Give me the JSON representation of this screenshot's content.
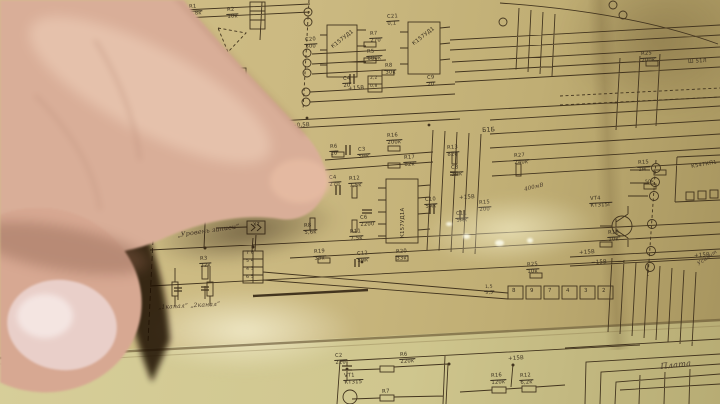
{
  "scene": {
    "palette": {
      "paper": "#cbb981",
      "paper_light": "#d8cf9b",
      "ink": "#3a3020",
      "skin": "#d9ae98",
      "skin_shadow": "#c79b85",
      "nail": "#e9cfc9",
      "deep_shadow": "#1a0d05",
      "tape_shine": "#fff9d7"
    }
  },
  "schematic": {
    "labels": [
      {
        "t": "R1|6,8к",
        "x": 188,
        "y": 5
      },
      {
        "t": "R2|10к",
        "x": 226,
        "y": 8
      },
      {
        "t": "Гром.",
        "x": 186,
        "y": 36,
        "h": 1,
        "s": 5.5,
        "r": -10
      },
      {
        "t": "С20|300",
        "x": 304,
        "y": 38
      },
      {
        "t": "С21|0,1",
        "x": 386,
        "y": 15
      },
      {
        "t": "R7|270",
        "x": 369,
        "y": 32
      },
      {
        "t": "R5|680к",
        "x": 366,
        "y": 50
      },
      {
        "t": "R8|30к",
        "x": 384,
        "y": 64
      },
      {
        "t": "С4|20",
        "x": 342,
        "y": 77
      },
      {
        "t": "2,2",
        "x": 370,
        "y": 77,
        "s": 4.3
      },
      {
        "t": "0,8",
        "x": 370,
        "y": 85,
        "s": 4.3
      },
      {
        "t": "С9|20",
        "x": 426,
        "y": 76
      },
      {
        "t": "+15В",
        "x": 348,
        "y": 87,
        "s": 5.5
      },
      {
        "t": "К157УД1",
        "x": 331,
        "y": 46,
        "r": -38,
        "s": 5.4
      },
      {
        "t": "К157УД1",
        "x": 412,
        "y": 43,
        "r": -38,
        "s": 5.4
      },
      {
        "t": "R25|200к",
        "x": 640,
        "y": 52
      },
      {
        "t": "Ш 51Л",
        "x": 688,
        "y": 60
      },
      {
        "t": "−0,5В",
        "x": 292,
        "y": 124,
        "s": 5.4
      },
      {
        "t": "R6|10",
        "x": 329,
        "y": 145
      },
      {
        "t": "С3|5мк",
        "x": 357,
        "y": 148
      },
      {
        "t": "R16|200к",
        "x": 386,
        "y": 134
      },
      {
        "t": "R17|82к",
        "x": 403,
        "y": 156
      },
      {
        "t": "Б1Б",
        "x": 482,
        "y": 128,
        "s": 6.2
      },
      {
        "t": "R13|820",
        "x": 446,
        "y": 146
      },
      {
        "t": "С8|3мк",
        "x": 450,
        "y": 166
      },
      {
        "t": "R27|240к",
        "x": 513,
        "y": 154
      },
      {
        "t": "400мВ",
        "x": 524,
        "y": 188,
        "r": -14,
        "h": 1,
        "s": 5.4
      },
      {
        "t": "С4|270",
        "x": 328,
        "y": 176
      },
      {
        "t": "R12|7,5к",
        "x": 348,
        "y": 177
      },
      {
        "t": "С6|2200",
        "x": 359,
        "y": 216
      },
      {
        "t": "R8|5,6к",
        "x": 303,
        "y": 224
      },
      {
        "t": "R11|7,5к",
        "x": 349,
        "y": 230
      },
      {
        "t": "С10|5мк",
        "x": 424,
        "y": 198
      },
      {
        "t": "С11|5мк",
        "x": 455,
        "y": 212
      },
      {
        "t": "+15В",
        "x": 459,
        "y": 196,
        "s": 5.4
      },
      {
        "t": "R15|200",
        "x": 478,
        "y": 201
      },
      {
        "t": "К157УД1А",
        "x": 401,
        "y": 238,
        "r": -90,
        "s": 5.4
      },
      {
        "t": "„Уровень записи”",
        "x": 177,
        "y": 232,
        "h": 1,
        "s": 6.4,
        "r": -8
      },
      {
        "t": "Х7",
        "x": 253,
        "y": 223,
        "s": 5
      },
      {
        "t": "7 6",
        "x": 246,
        "y": 252,
        "s": 4.6
      },
      {
        "t": "5 4",
        "x": 246,
        "y": 260,
        "s": 4.6
      },
      {
        "t": "4 3",
        "x": 246,
        "y": 268,
        "s": 4.6
      },
      {
        "t": "6 5",
        "x": 246,
        "y": 276,
        "s": 4.6
      },
      {
        "t": "R3|22к",
        "x": 199,
        "y": 257
      },
      {
        "t": "„1канал”  „2канал”",
        "x": 158,
        "y": 305,
        "h": 1,
        "s": 6,
        "r": -3
      },
      {
        "t": "R19|33к",
        "x": 313,
        "y": 250
      },
      {
        "t": "С12|5мк",
        "x": 356,
        "y": 252
      },
      {
        "t": "R20|33к",
        "x": 395,
        "y": 250
      },
      {
        "t": "R25|10к",
        "x": 526,
        "y": 263
      },
      {
        "t": "1,5|3,5",
        "x": 484,
        "y": 286,
        "s": 4.5
      },
      {
        "t": "+15В",
        "x": 579,
        "y": 251,
        "s": 5.4
      },
      {
        "t": "−15В",
        "x": 591,
        "y": 261,
        "s": 5.4
      },
      {
        "t": "VT4|КТ315Г",
        "x": 589,
        "y": 197
      },
      {
        "t": "R18|10к",
        "x": 607,
        "y": 231
      },
      {
        "t": "R15|1м",
        "x": 637,
        "y": 161
      },
      {
        "t": "50к",
        "x": 645,
        "y": 181,
        "s": 4.5
      },
      {
        "t": "К547КП1",
        "x": 691,
        "y": 165,
        "r": -10
      },
      {
        "t": "+15В",
        "x": 694,
        "y": 254,
        "s": 5.4
      },
      {
        "t": "Усилит",
        "x": 697,
        "y": 263,
        "r": -35,
        "h": 1
      },
      {
        "t": "8",
        "x": 512,
        "y": 289,
        "s": 5.4
      },
      {
        "t": "9",
        "x": 530,
        "y": 289,
        "s": 5.4
      },
      {
        "t": "7",
        "x": 548,
        "y": 289,
        "s": 5.4
      },
      {
        "t": "4",
        "x": 566,
        "y": 289,
        "s": 5.4
      },
      {
        "t": "3",
        "x": 584,
        "y": 289,
        "s": 5.4
      },
      {
        "t": "2",
        "x": 602,
        "y": 289,
        "s": 5.4
      },
      {
        "t": "С2|220",
        "x": 334,
        "y": 354
      },
      {
        "t": "R6|220к",
        "x": 399,
        "y": 353
      },
      {
        "t": "VT1|КТ315",
        "x": 343,
        "y": 374
      },
      {
        "t": "R7",
        "x": 382,
        "y": 390,
        "s": 5.4
      },
      {
        "t": "+15В",
        "x": 508,
        "y": 357,
        "s": 5.4
      },
      {
        "t": "R16|120к",
        "x": 490,
        "y": 374
      },
      {
        "t": "R12|6,2к",
        "x": 519,
        "y": 374
      },
      {
        "t": "Плата",
        "x": 660,
        "y": 362,
        "h": 1,
        "s": 8.2,
        "r": -6
      }
    ]
  }
}
